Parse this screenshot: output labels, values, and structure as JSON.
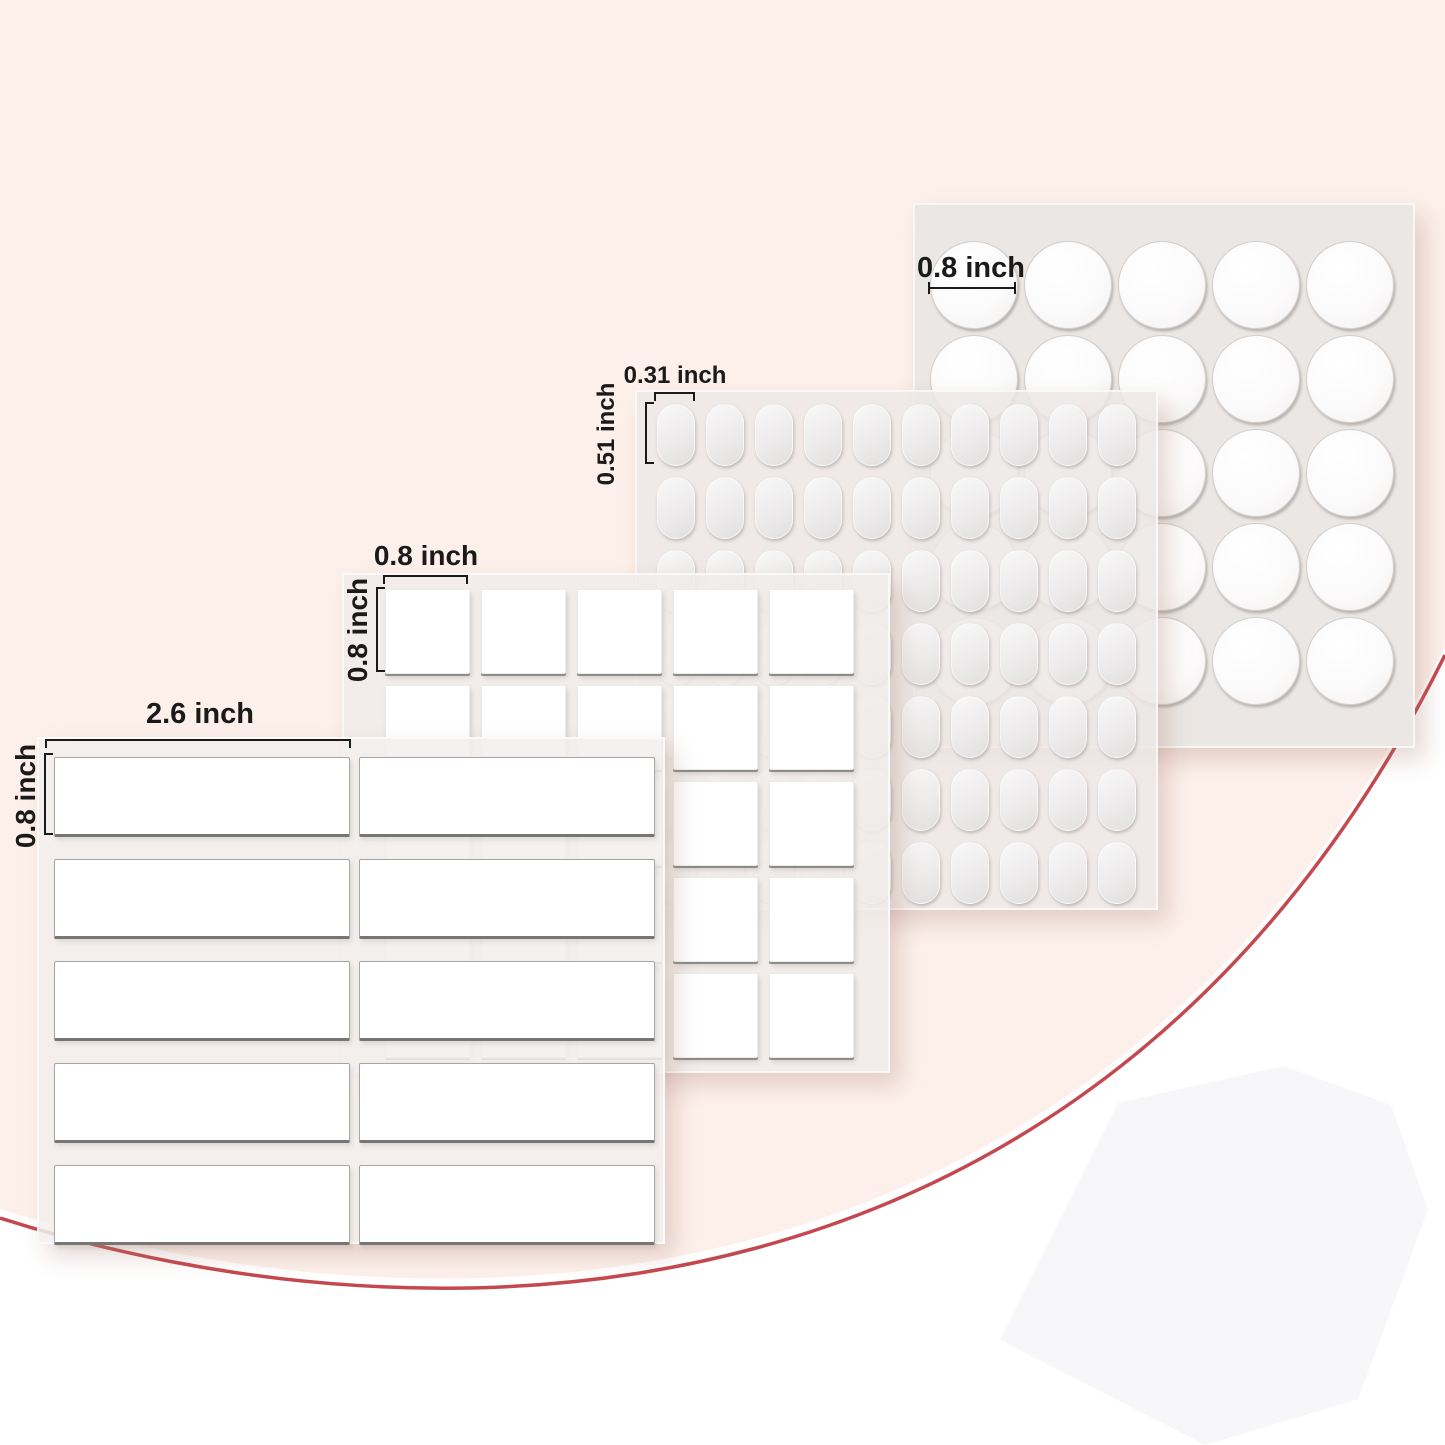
{
  "page": {
    "colors": {
      "bg_white": "#ffffff",
      "bg_pink": "#fdf0eb",
      "accent_red": "#c4484f",
      "heptagon_gray": "#f7f6f8",
      "sheet_gray": "#ebe7e4",
      "text_dark": "#1a1a1a"
    }
  },
  "sheets": {
    "circles": {
      "rows": 5,
      "cols": 5,
      "width_label": "0.8 inch"
    },
    "ovals": {
      "rows": 7,
      "cols": 10,
      "width_label": "0.31 inch",
      "height_label": "0.51 inch"
    },
    "squares": {
      "rows": 5,
      "cols": 5,
      "width_label": "0.8 inch",
      "height_label": "0.8 inch"
    },
    "rects": {
      "rows": 5,
      "cols": 2,
      "width_label": "2.6 inch",
      "height_label": "0.8 inch"
    }
  }
}
